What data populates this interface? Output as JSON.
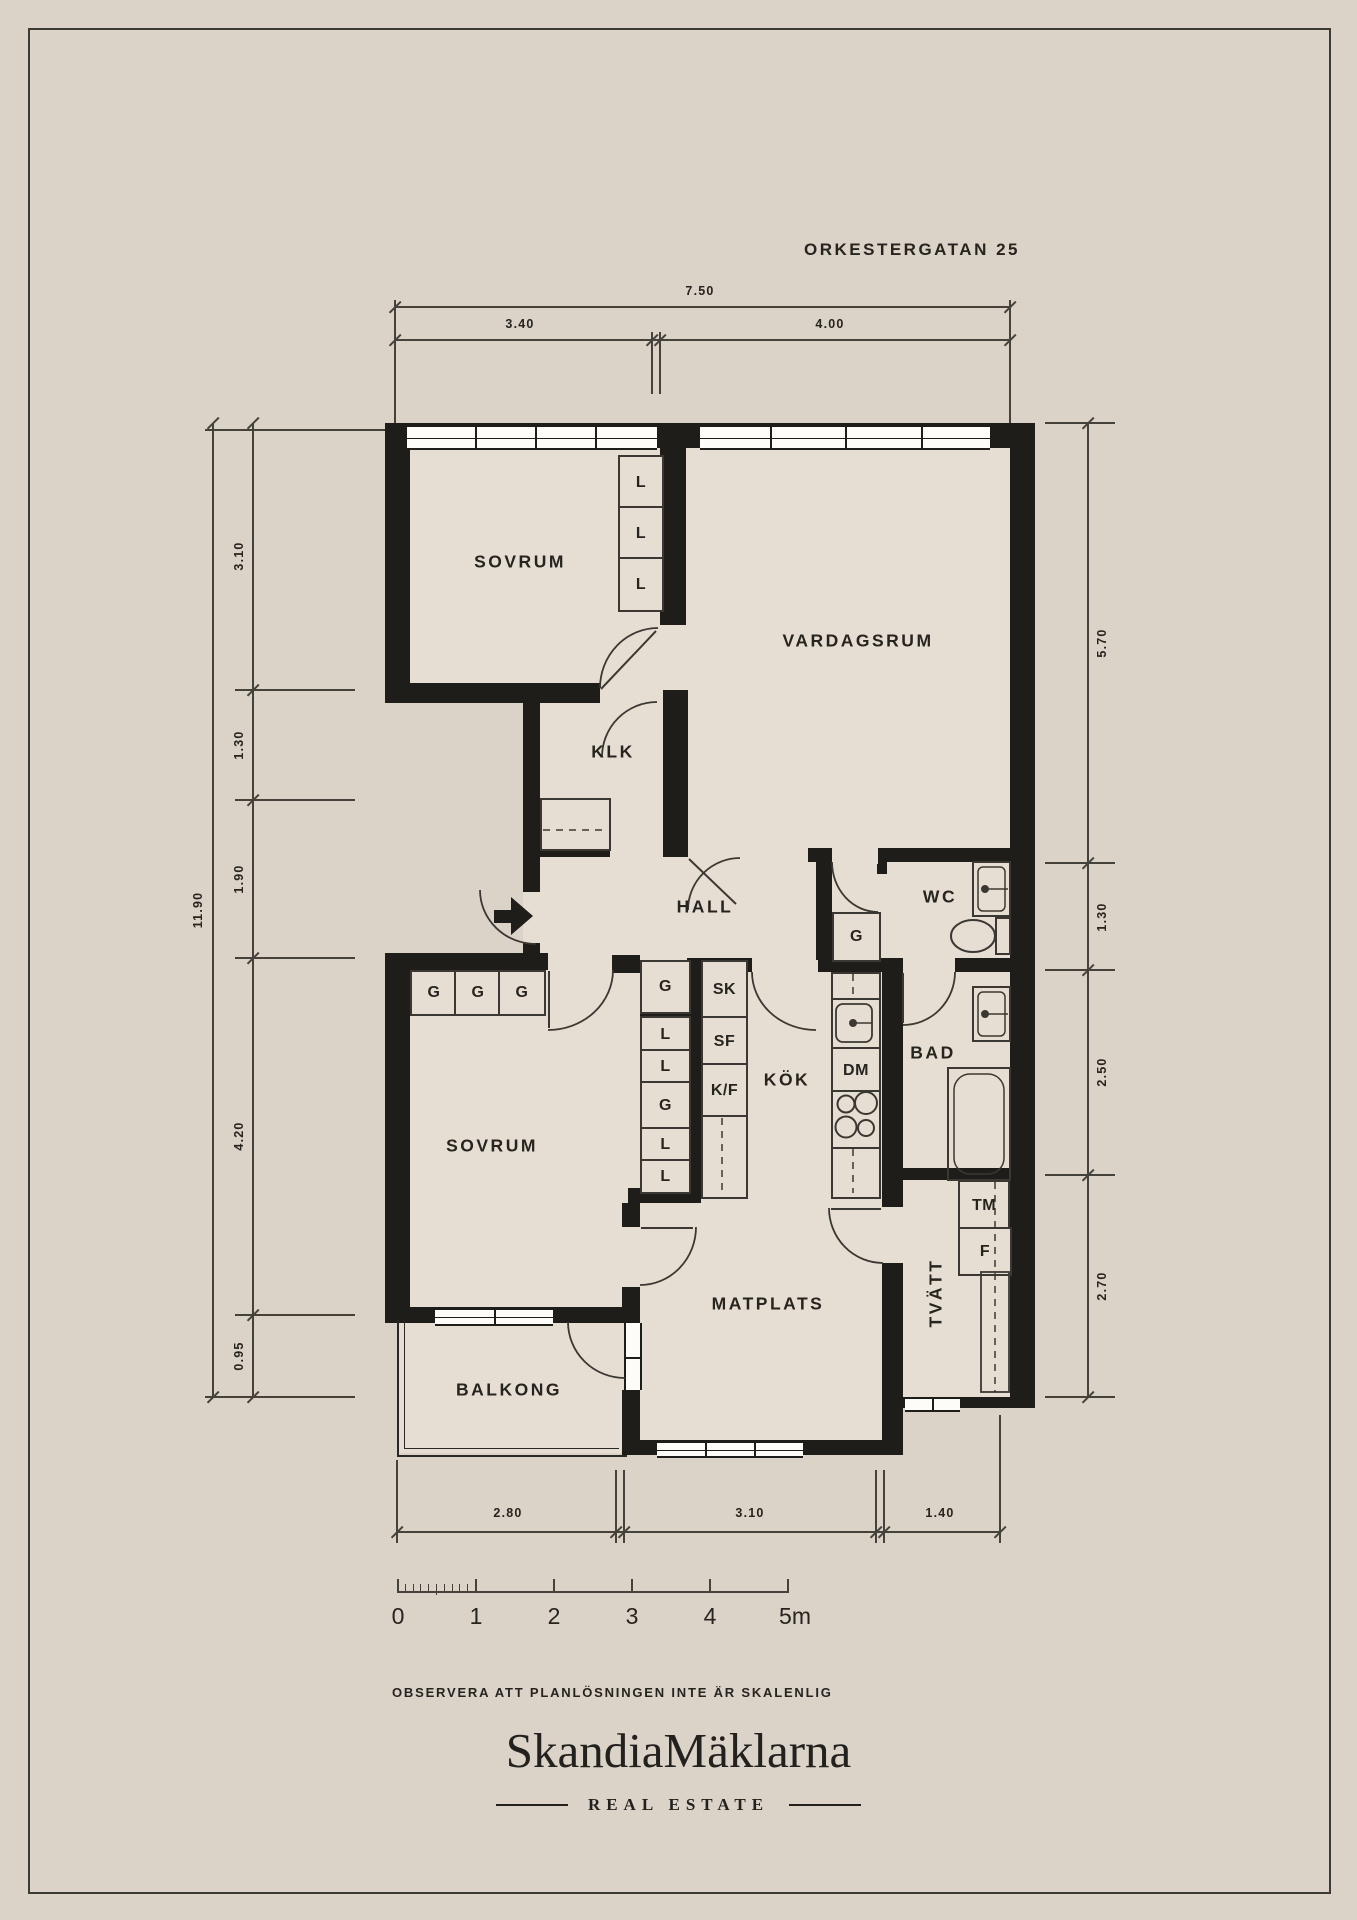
{
  "title": "ORKESTERGATAN 25",
  "rooms": {
    "sovrum_top": "SOVRUM",
    "vardagsrum": "VARDAGSRUM",
    "klk": "KLK",
    "hall": "HALL",
    "wc": "WC",
    "bad": "BAD",
    "kok": "KÖK",
    "sovrum_bottom": "SOVRUM",
    "matplats": "MATPLATS",
    "tvatt": "TVÄTT",
    "balkong": "BALKONG"
  },
  "fixtures": {
    "l": "L",
    "g": "G",
    "sk": "SK",
    "sf": "SF",
    "kf": "K/F",
    "dm": "DM",
    "tm": "TM",
    "f": "F"
  },
  "dimensions": {
    "top": {
      "total": "7.50",
      "segments": [
        "3.40",
        "4.00"
      ]
    },
    "left": {
      "total": "11.90",
      "segments": [
        "3.10",
        "1.30",
        "1.90",
        "4.20",
        "0.95"
      ]
    },
    "right": {
      "segments": [
        "5.70",
        "1.30",
        "2.50",
        "2.70"
      ]
    },
    "bottom": {
      "segments": [
        "2.80",
        "3.10",
        "1.40"
      ]
    }
  },
  "scale_bar": {
    "labels": [
      "0",
      "1",
      "2",
      "3",
      "4",
      "5m"
    ]
  },
  "disclaimer": "OBSERVERA ATT PLANLÖSNINGEN INTE ÄR SKALENLIG",
  "brand": {
    "name": "SkandiaMäklarna",
    "tagline": "REAL ESTATE"
  },
  "colors": {
    "background": "#dbd2c8",
    "floor": "#e7ded3",
    "wall": "#1e1d1a",
    "line": "#3b3833",
    "window": "#fdfcf8",
    "text": "#26241f"
  }
}
